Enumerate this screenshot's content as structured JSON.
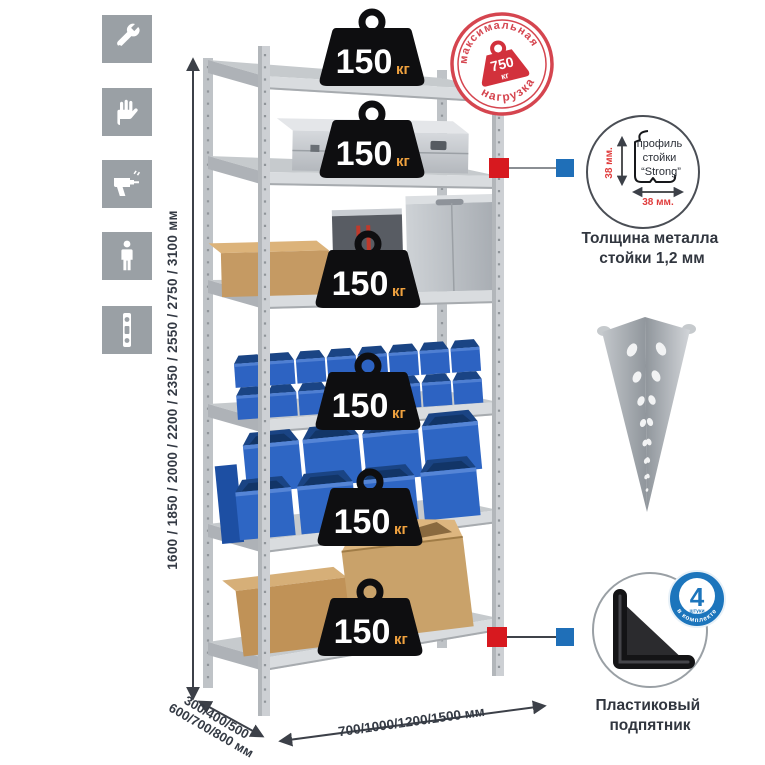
{
  "sidebar": {
    "icons": [
      {
        "name": "wrench-icon"
      },
      {
        "name": "gloves-icon"
      },
      {
        "name": "drill-icon"
      },
      {
        "name": "person-icon"
      },
      {
        "name": "spirit-level-icon"
      }
    ]
  },
  "dimensions": {
    "height_options": "1600 / 1850 / 2000 / 2200 / 2350 / 2550 / 2750 / 3100 мм",
    "depth_line1": "300/400/500",
    "depth_line2": "600/700/800 мм",
    "width_options": "700/1000/1200/1500 мм"
  },
  "rack": {
    "shelf_count": 6,
    "shelf_load_value": "150",
    "shelf_load_unit": "кг"
  },
  "stamp": {
    "arc_top": "максимальная",
    "arc_bottom": "нагрузка",
    "value": "750",
    "unit": "кг"
  },
  "profile_detail": {
    "label_line1": "профиль",
    "label_line2": "стойки",
    "label_line3": "“Strong”",
    "dim_vertical": "38 мм.",
    "dim_horizontal": "38 мм.",
    "caption_line1": "Толщина металла",
    "caption_line2": "стойки 1,2 мм"
  },
  "foot_detail": {
    "badge_value": "4",
    "badge_subtext": "штуки",
    "badge_arc": "в комплекте",
    "caption_line1": "Пластиковый",
    "caption_line2": "подпятник"
  },
  "colors": {
    "accent_red": "#d7191f",
    "accent_blue": "#1f6fb8",
    "stamp_red": "#d5454f",
    "stamp_weight_red": "#d2313c",
    "bin_blue": "#2d63c2",
    "weight_unit_orange": "#f0a23f",
    "badge_blue": "#1c75bc",
    "tile_gray": "#9aa0a5"
  }
}
